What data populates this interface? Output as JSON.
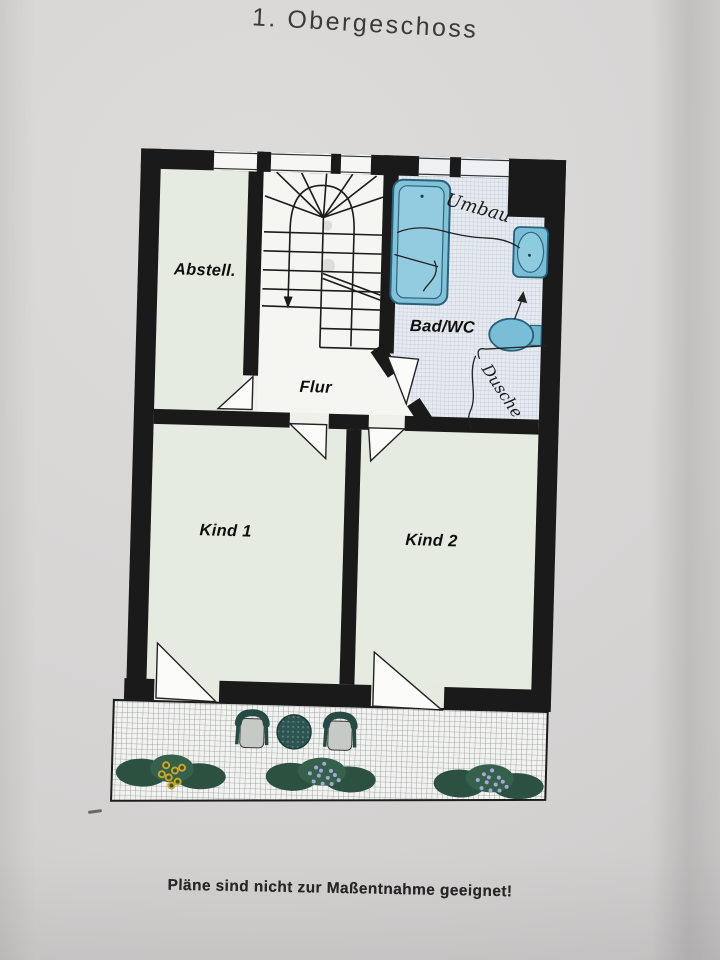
{
  "page": {
    "title": "1. Obergeschoss",
    "caption": "Pläne sind nicht zur Maßentnahme geeignet!"
  },
  "floorplan": {
    "floor": "1. Obergeschoss",
    "rooms": {
      "abstell": {
        "label": "Abstell."
      },
      "flur": {
        "label": "Flur"
      },
      "bad": {
        "label": "Bad/WC"
      },
      "kind1": {
        "label": "Kind 1"
      },
      "kind2": {
        "label": "Kind 2"
      }
    },
    "handwriting": {
      "near_bathtub": "Umbau",
      "shower_area": "Dusche"
    },
    "fixtures": [
      "stairs",
      "bathtub",
      "sink",
      "toilet",
      "balcony",
      "balcony-table",
      "balcony-chairs",
      "flower-boxes"
    ],
    "colors": {
      "wall": "#1a1a1a",
      "room_floor": "#e6ebe1",
      "corridor_floor": "#f5f5f2",
      "bath_tile": "#e7ebf1",
      "fixture_blue": "#82c1d8",
      "fixture_blue_dark": "#27617a",
      "paper": "#d8d6d5",
      "foliage_green": "#2c5140",
      "flower_yellow": "#c7a52e",
      "flower_violet": "#a3a8d6",
      "furniture_teal": "#2d5450"
    }
  }
}
